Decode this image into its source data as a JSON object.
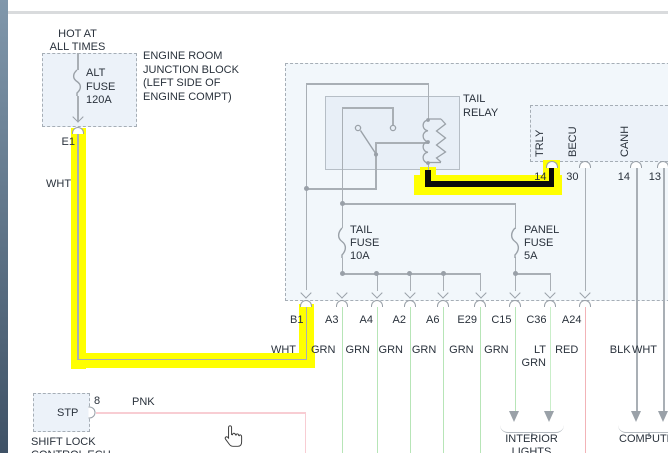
{
  "colors": {
    "highlight_yellow": "#ffff00",
    "black_wire": "#0b0b0b",
    "gray_wire": "#a9afb5",
    "green_wire": "#b7e5b7",
    "lt_green_wire": "#c9eec9",
    "red_wire": "#f2b3b7",
    "pink_wire": "#f8cdd3"
  },
  "power": {
    "l1": "HOT AT",
    "l2": "ALL TIMES"
  },
  "alt_fuse": {
    "l1": "ALT",
    "l2": "FUSE",
    "l3": "120A"
  },
  "jb_note": {
    "l1": "ENGINE ROOM",
    "l2": "JUNCTION BLOCK",
    "l3": "(LEFT SIDE OF",
    "l4": "ENGINE COMPT)"
  },
  "e1": "E1",
  "wht": "WHT",
  "relay": {
    "l1": "TAIL",
    "l2": "RELAY"
  },
  "tail_fuse": {
    "l1": "TAIL",
    "l2": "FUSE",
    "l3": "10A"
  },
  "panel_fuse": {
    "l1": "PANEL",
    "l2": "FUSE",
    "l3": "5A"
  },
  "ecu": {
    "s1": "TRLY",
    "s2": "BECU",
    "s3": "CANH",
    "p1": "14",
    "p2": "30",
    "p3": "14",
    "p4": "13"
  },
  "pins": {
    "p1": "B1",
    "p2": "A3",
    "p3": "A4",
    "p4": "A2",
    "p5": "A6",
    "p6": "E29",
    "p7": "C15",
    "p8": "C36",
    "p9": "A24"
  },
  "wires": {
    "w1": "WHT",
    "w2": "GRN",
    "w3": "GRN",
    "w4": "GRN",
    "w5": "GRN",
    "w6": "GRN",
    "w7": "GRN",
    "w8a": "LT",
    "w8b": "GRN",
    "w9": "RED",
    "w10": "BLK",
    "w11": "WHT"
  },
  "stp": {
    "box": "STP",
    "pin": "8",
    "wire": "PNK",
    "n1": "SHIFT LOCK",
    "n2": "CONTROL ECU"
  },
  "dest": {
    "i1": "INTERIOR",
    "i2": "LIGHTS",
    "c1": "COMPUTER"
  }
}
